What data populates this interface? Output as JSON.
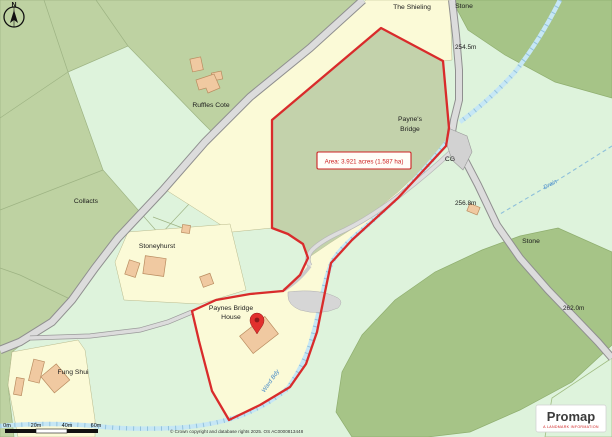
{
  "map": {
    "compass": {
      "north_label": "N"
    },
    "area_annotation": "Area: 3.921 acres (1.587 ha)",
    "place_labels": {
      "the_shieling": "The Shieling",
      "stone_north": "Stone",
      "spot_height_north": "254.5m",
      "paynes_bridge_line1": "Payne's",
      "paynes_bridge_line2": "Bridge",
      "cg": "CG",
      "ruffles_cote": "Ruffles Cote",
      "collacts": "Collacts",
      "stoneyhurst": "Stoneyhurst",
      "paynes_bridge_house_line1": "Paynes Bridge",
      "paynes_bridge_house_line2": "House",
      "fung_shui": "Fung Shui",
      "spot_height_mid": "256.8m",
      "stone_east": "Stone",
      "spot_height_south": "262.0m",
      "drain": "Drain",
      "ward_bdy": "Ward Bdy",
      "stream_name_partial": "Blackmoor"
    },
    "colors": {
      "boundary_red": "#d92b2b",
      "field_sage": "#c3d2ab",
      "parcel_yellow": "#fbfad7",
      "grass_mint": "#def3dc",
      "woodland_green": "#a6c487",
      "water_blue": "#c6e7f5",
      "road_grey": "#dcdcdc",
      "building_tan": "#f0c9a1"
    }
  },
  "scale_bar": {
    "ticks": [
      "0m",
      "20m",
      "40m",
      "60m"
    ]
  },
  "footer": {
    "copyright": "© Crown copyright and database rights 2025. OS AC0000813448"
  },
  "branding": {
    "name": "Promap",
    "tagline": "A LANDMARK INFORMATION"
  }
}
